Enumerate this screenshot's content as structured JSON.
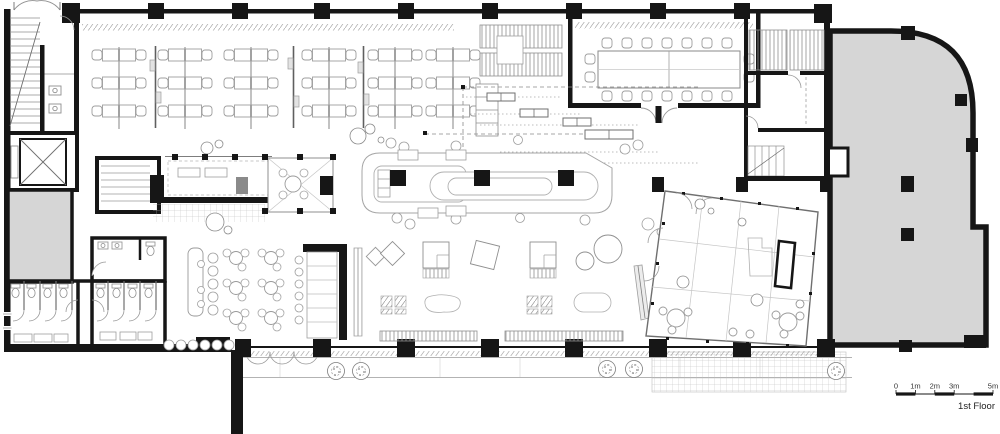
{
  "meta": {
    "floor_label": "1st Floor"
  },
  "scale_bar": {
    "labels": [
      "0",
      "1m",
      "2m",
      "3m",
      "5m"
    ],
    "total_meters": 5
  },
  "colors": {
    "wall": "#161616",
    "shell_fill": "#d6d6d6",
    "furniture_line": "#9e9e9e",
    "background": "#ffffff"
  }
}
